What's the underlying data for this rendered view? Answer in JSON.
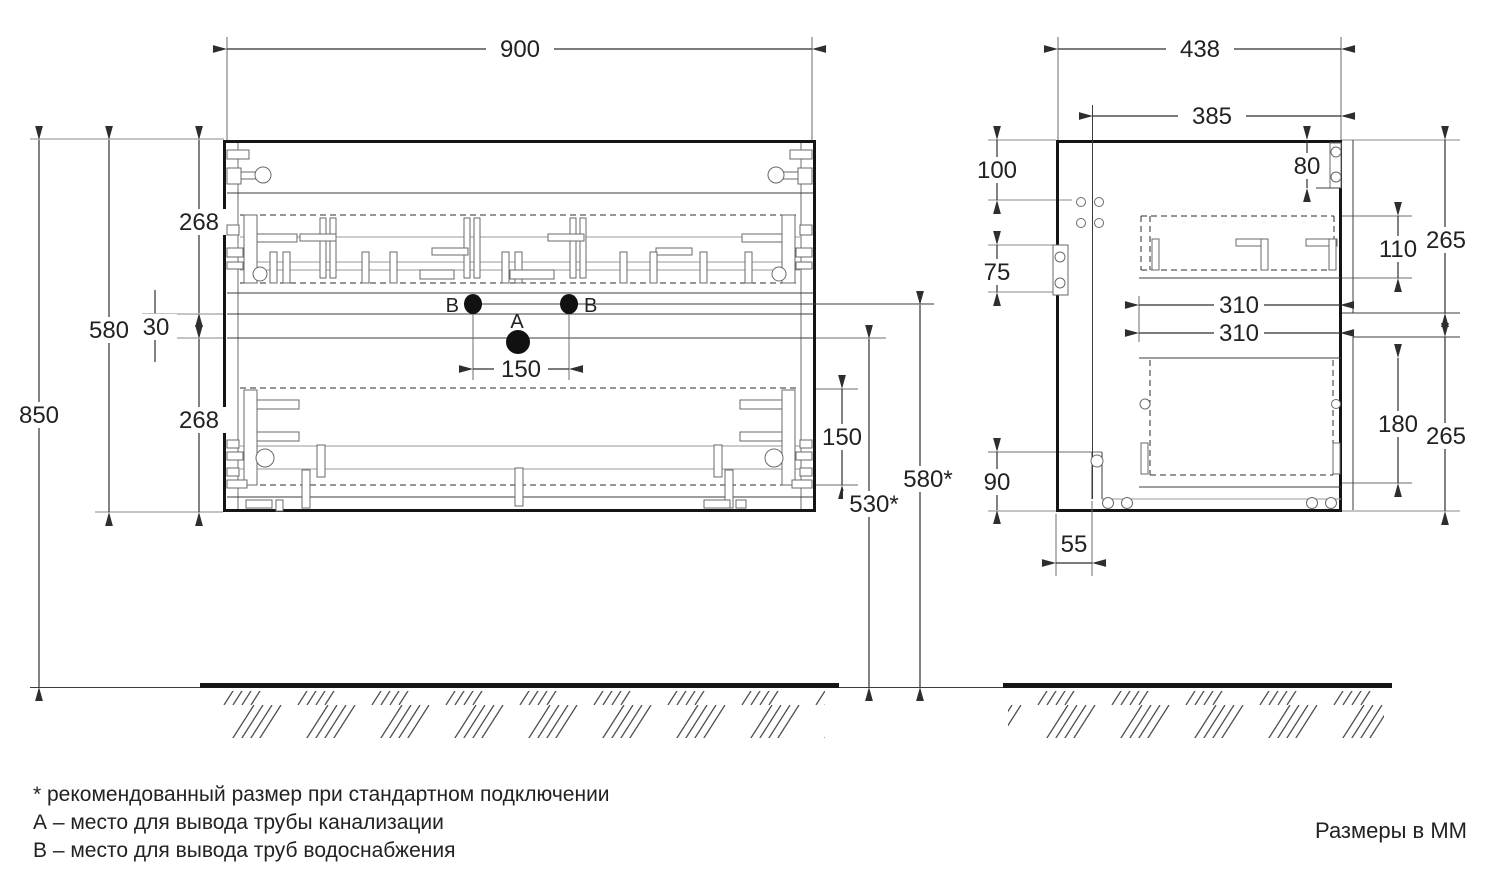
{
  "units_note": "Размеры в ММ",
  "notes": [
    "* рекомендованный размер при стандартном подключении",
    "А – место для вывода трубы канализации",
    "В – место для вывода труб водоснабжения"
  ],
  "front": {
    "dims": {
      "width": "900",
      "total_height": "850",
      "cabinet_height": "580",
      "top_drawer_height": "268",
      "gap": "30",
      "bottom_drawer_height": "268",
      "holes_spacing": "150",
      "drawer_box_height": "150",
      "drain_outlet_height": "530*",
      "water_outlet_height": "580*"
    },
    "labels": {
      "drain": "А",
      "water_left": "В",
      "water_right": "В"
    }
  },
  "side": {
    "dims": {
      "depth": "438",
      "inner_depth": "385",
      "hole_top_offset": "100",
      "hinge_plate_height": "80",
      "mount_plate_height": "75",
      "top_box_height": "110",
      "top_front_height": "265",
      "top_box_depth": "310",
      "bottom_box_depth": "310",
      "bottom_box_height": "180",
      "bottom_front_height": "265",
      "bottom_offset": "90",
      "back_recess": "55"
    }
  }
}
